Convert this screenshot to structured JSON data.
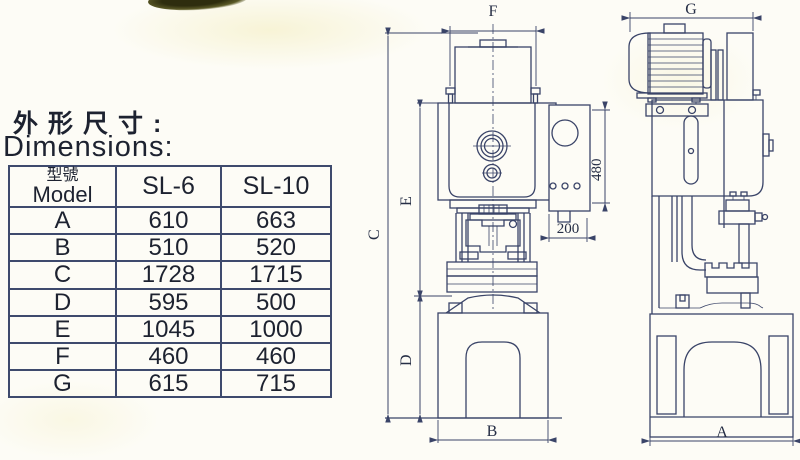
{
  "title": {
    "cn": "外形尺寸:",
    "en": "Dimensions:"
  },
  "table": {
    "header": {
      "model_cn": "型號",
      "model_en": "Model",
      "col_sl6": "SL-6",
      "col_sl10": "SL-10"
    },
    "rows": [
      {
        "dim": "A",
        "sl6": "610",
        "sl10": "663"
      },
      {
        "dim": "B",
        "sl6": "510",
        "sl10": "520"
      },
      {
        "dim": "C",
        "sl6": "1728",
        "sl10": "1715"
      },
      {
        "dim": "D",
        "sl6": "595",
        "sl10": "500"
      },
      {
        "dim": "E",
        "sl6": "1045",
        "sl10": "1000"
      },
      {
        "dim": "F",
        "sl6": "460",
        "sl10": "460"
      },
      {
        "dim": "G",
        "sl6": "615",
        "sl10": "715"
      }
    ]
  },
  "front_view": {
    "dim_f": "F",
    "dim_c": "C",
    "dim_e": "E",
    "dim_d": "D",
    "dim_b": "B",
    "panel_height": "480",
    "panel_offset": "200"
  },
  "side_view": {
    "dim_g": "G",
    "dim_a": "A"
  },
  "colors": {
    "line": "#3a4468",
    "text": "#1d2230"
  }
}
